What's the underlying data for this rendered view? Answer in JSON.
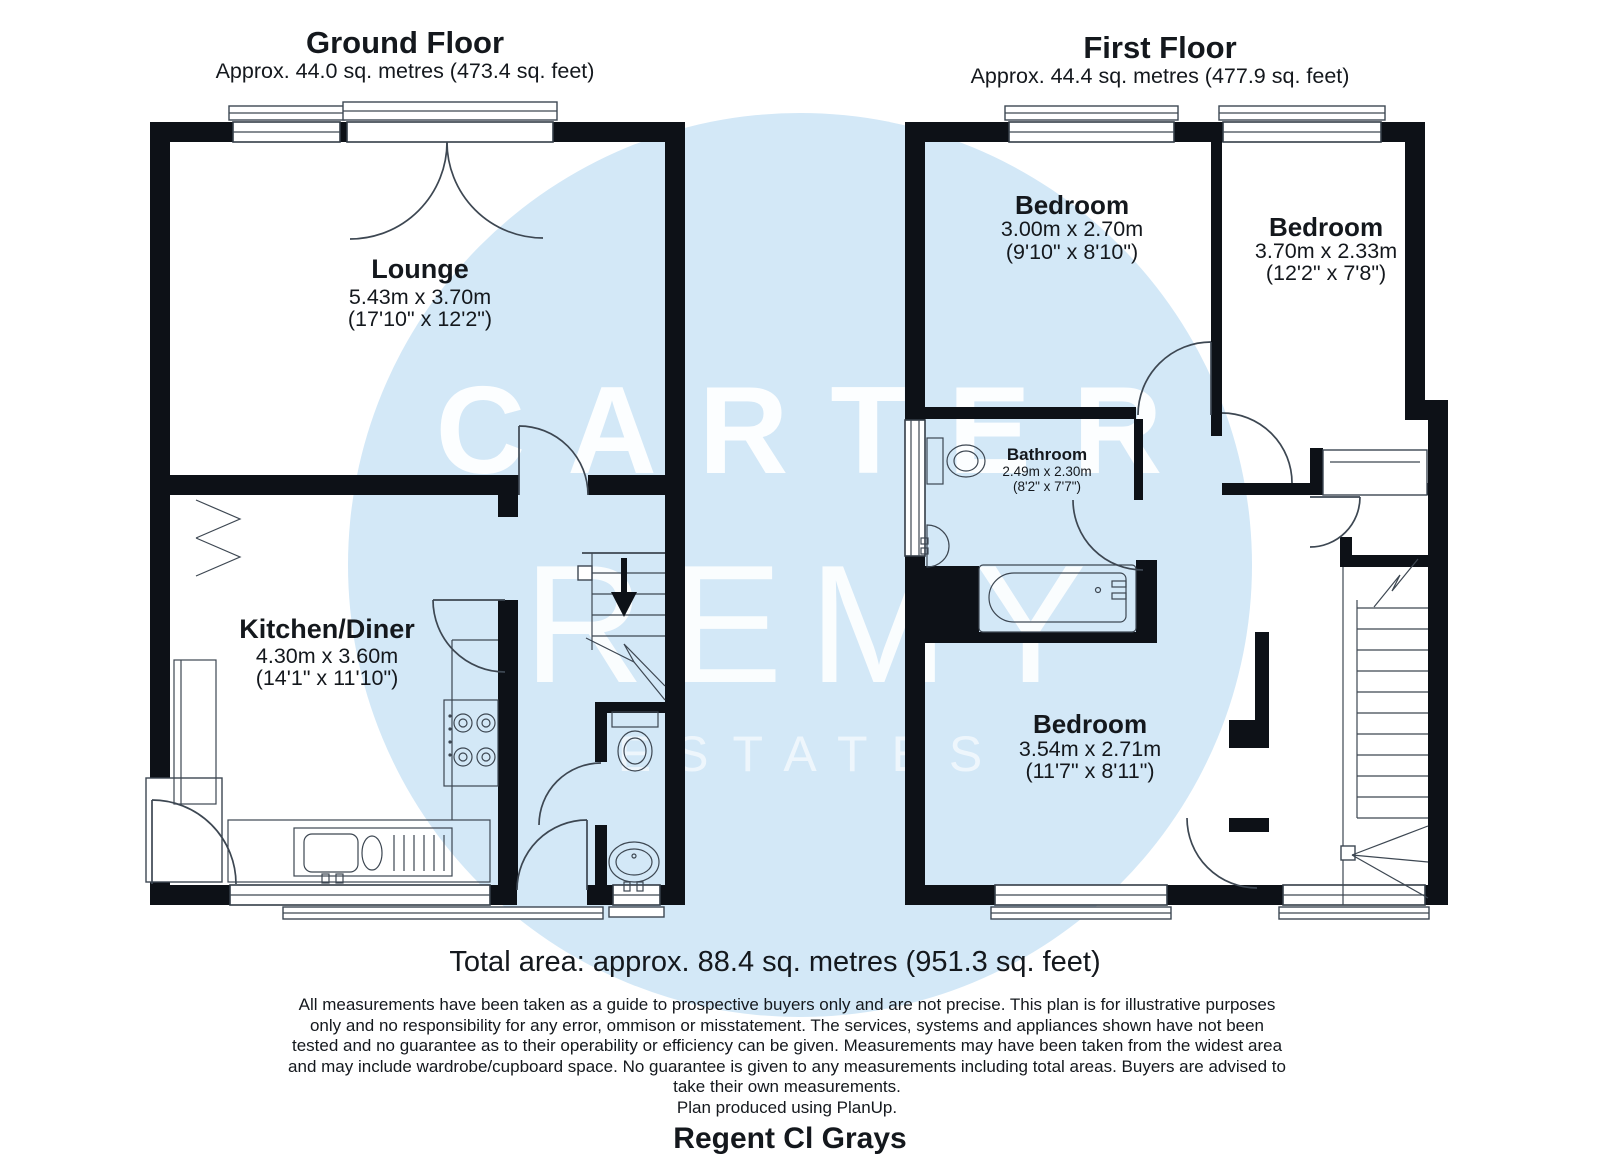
{
  "watermark": {
    "line1": "CARTER",
    "line2": "REMY",
    "line3": "ESTATES",
    "circle_color": "#d3e8f7",
    "text_color": "#ffffff"
  },
  "ground_floor": {
    "title": "Ground Floor",
    "subtitle": "Approx. 44.0 sq. metres (473.4 sq. feet)",
    "rooms": {
      "lounge": {
        "name": "Lounge",
        "metric": "5.43m x 3.70m",
        "imperial": "(17'10\" x 12'2\")"
      },
      "kitchen_diner": {
        "name": "Kitchen/Diner",
        "metric": "4.30m x 3.60m",
        "imperial": "(14'1\" x 11'10\")"
      }
    }
  },
  "first_floor": {
    "title": "First Floor",
    "subtitle": "Approx. 44.4 sq. metres (477.9 sq. feet)",
    "rooms": {
      "bedroom_front": {
        "name": "Bedroom",
        "metric": "3.00m x 2.70m",
        "imperial": "(9'10\" x 8'10\")"
      },
      "bedroom_side": {
        "name": "Bedroom",
        "metric": "3.70m x 2.33m",
        "imperial": "(12'2\" x 7'8\")"
      },
      "bathroom": {
        "name": "Bathroom",
        "metric": "2.49m x 2.30m",
        "imperial": "(8'2\" x 7'7\")"
      },
      "bedroom_back": {
        "name": "Bedroom",
        "metric": "3.54m x 2.71m",
        "imperial": "(11'7\" x 8'11\")"
      }
    }
  },
  "footer": {
    "total_area": "Total area: approx. 88.4 sq. metres (951.3 sq. feet)",
    "disclaimer_lines": [
      "All measurements have been taken as a guide to prospective buyers only and are not precise. This plan is for illustrative purposes",
      "only and no responsibility for any error, ommison or misstatement. The services, systems and appliances shown have not been",
      "tested and no guarantee as to their operability or efficiency can be given. Measurements may have been taken from the widest area",
      "and may include wardrobe/cupboard space. No guarantee is given to any measurements including total areas. Buyers are advised to",
      "take their own measurements.",
      "Plan produced using PlanUp."
    ],
    "address": "Regent Cl Grays"
  }
}
